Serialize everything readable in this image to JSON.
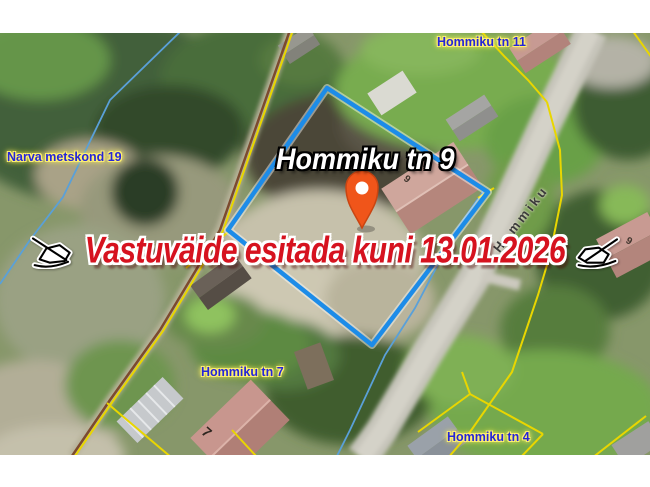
{
  "overlay": {
    "title": "Hommiku tn 9",
    "notice": "Vastuväide esitada kuni 13.01.2026"
  },
  "labels": {
    "narva": "Narva metskond 19",
    "tn11": "Hommiku tn 11",
    "tn7": "Hommiku tn 7",
    "tn4": "Hommiku tn 4",
    "street": "Hommiku"
  },
  "house_numbers": {
    "parcel9": "9",
    "house7": "7",
    "house9": "9"
  },
  "icons": {
    "pin": "location-pin-icon",
    "signature_left": "signature-pen-icon",
    "signature_right": "signature-pen-icon"
  },
  "colors": {
    "parcel_outline": "#1d8ce8",
    "cadastral_line": "#e9d600",
    "stream_line": "#5aa0d8",
    "label_text": "#2525d8",
    "label_halo": "#fff170",
    "notice_text": "#d6121f",
    "pin_fill": "#f0551a"
  }
}
